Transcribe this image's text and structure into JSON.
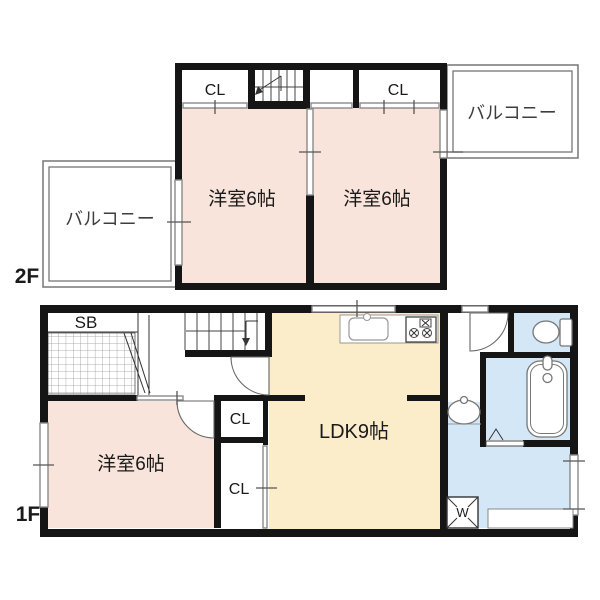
{
  "floor2": {
    "label": "2F",
    "balcony_left": "バルコニー",
    "balcony_right": "バルコニー",
    "closet_left": "CL",
    "closet_right": "CL",
    "room_left": "洋室6帖",
    "room_right": "洋室6帖"
  },
  "floor1": {
    "label": "1F",
    "shoe_box": "SB",
    "bedroom": "洋室6帖",
    "closet_upper": "CL",
    "closet_lower": "CL",
    "ldk": "LDK9帖",
    "washer": "W"
  },
  "colors": {
    "room_pink": "#f9e4db",
    "ldk_cream": "#fbedca",
    "wet_blue": "#d3e7f6",
    "wall": "#151515",
    "opening_gray": "#8a8a8a"
  }
}
